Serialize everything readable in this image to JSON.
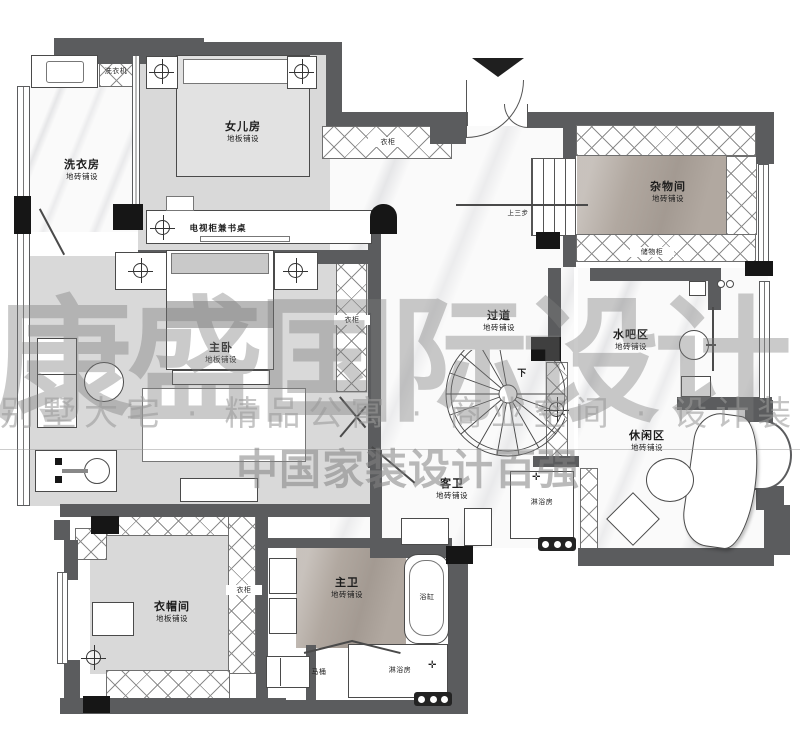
{
  "watermark": {
    "brand": "康盛国际设计",
    "tagline": "别墅大宅 · 精品公寓 · 商业空间 · 设计装修",
    "subtitle": "中国家装设计百强"
  },
  "rooms": {
    "laundry": {
      "name": "洗衣房",
      "finish": "地砖铺设"
    },
    "daughter": {
      "name": "女儿房",
      "finish": "地板铺设"
    },
    "storage": {
      "name": "杂物间",
      "finish": "地砖铺设"
    },
    "master": {
      "name": "主卧",
      "finish": "地板铺设"
    },
    "corridor": {
      "name": "过道",
      "finish": "地砖铺设"
    },
    "waterbar": {
      "name": "水吧区",
      "finish": "地砖铺设"
    },
    "leisure": {
      "name": "休闲区",
      "finish": "地砖铺设"
    },
    "cloakroom": {
      "name": "衣帽间",
      "finish": "地板铺设"
    },
    "master_bath": {
      "name": "主卫",
      "finish": "地砖铺设"
    },
    "guest_bath": {
      "name": "客卫",
      "finish": "地砖铺设"
    }
  },
  "fixtures": {
    "washer": "洗衣机",
    "tv_desk": "电视柜兼书桌",
    "wardrobe_corridor": "衣柜",
    "wardrobe_master": "衣柜",
    "wardrobe_cloak": "衣柜",
    "storage_cabinet": "储物柜",
    "steps_up": "上三步",
    "stairs_down": "下",
    "bathtub": "浴缸",
    "toilet": "马桶",
    "shower_master": "淋浴房",
    "shower_guest": "淋浴房"
  },
  "colors": {
    "wall": "#5b5c5e",
    "column": "#161616",
    "wood_floor": "#d9d9d9",
    "stone_floor": "#b1a8a0",
    "watermark_gray": "#7d7d7d"
  }
}
